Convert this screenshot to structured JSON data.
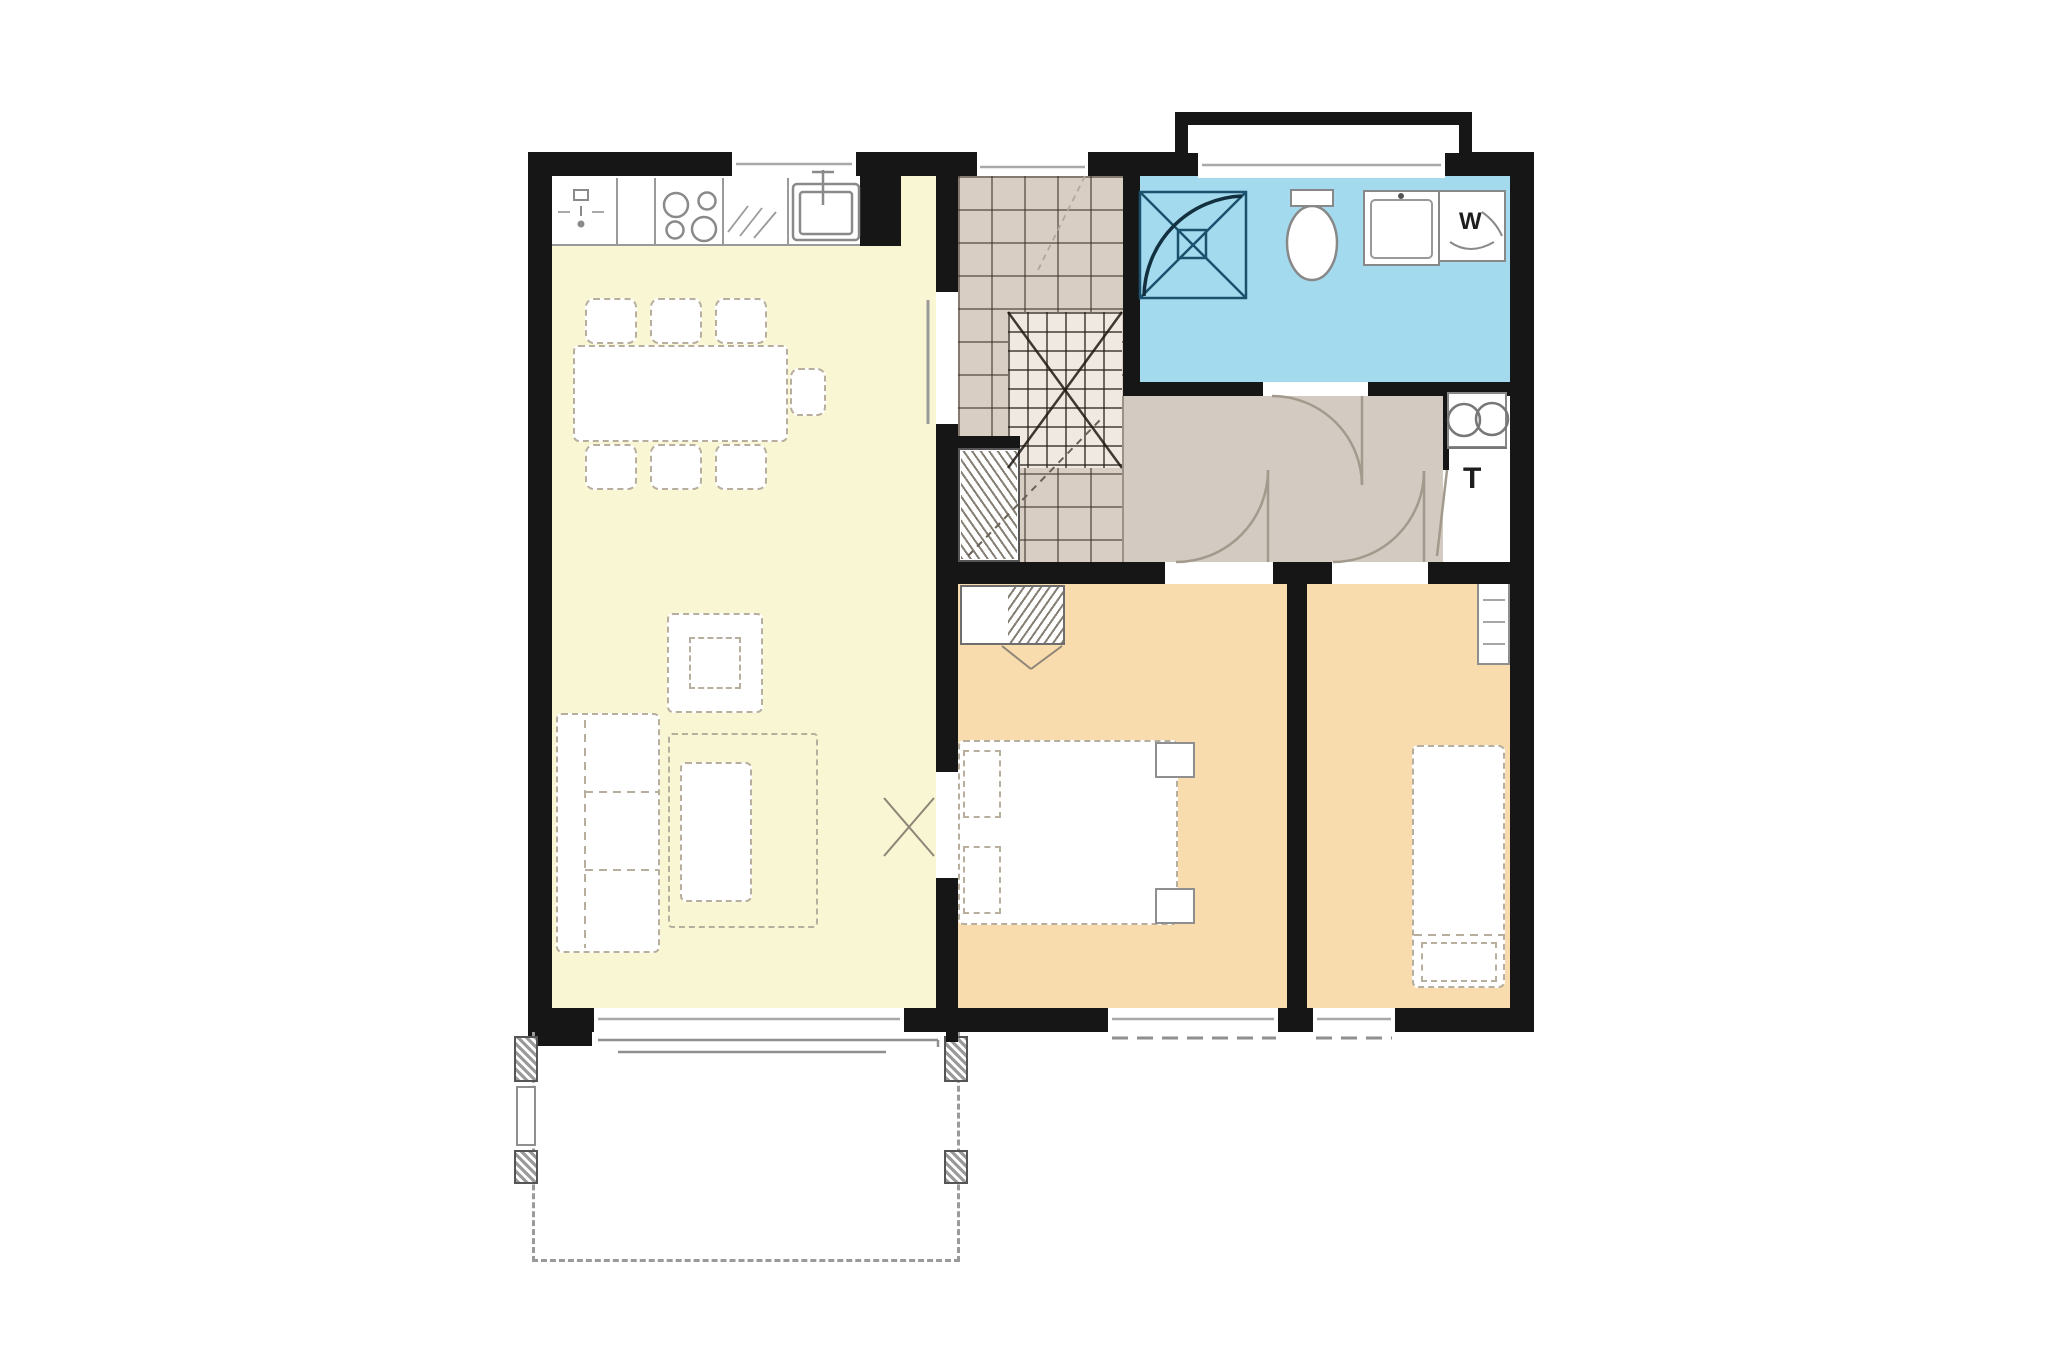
{
  "labels": {
    "washer": "W",
    "tech": "T"
  },
  "colors": {
    "wall": "#161616",
    "living": "#f9f6d3",
    "bedroom": "#f8dcad",
    "bathroom": "#a3daee",
    "tile": "#d9cec3",
    "hall": "#d3cac1",
    "flight": "#efe9e1",
    "outline": "#8f8f8f",
    "dash": "#b7ae9e",
    "fixture": "#8a8a8a",
    "shower": "#1c516d"
  },
  "rooms": [
    {
      "name": "kitchen-living-dining",
      "floor_color": "#f9f6d3"
    },
    {
      "name": "entry-stairs",
      "floor_color": "#d9cec3"
    },
    {
      "name": "hallway",
      "floor_color": "#d3cac1"
    },
    {
      "name": "bathroom",
      "floor_color": "#a3daee"
    },
    {
      "name": "tech-closet",
      "floor_color": "#ffffff"
    },
    {
      "name": "bedroom-1",
      "floor_color": "#f8dcad"
    },
    {
      "name": "bedroom-2",
      "floor_color": "#f8dcad"
    },
    {
      "name": "terrace",
      "floor_color": "#ffffff"
    }
  ]
}
